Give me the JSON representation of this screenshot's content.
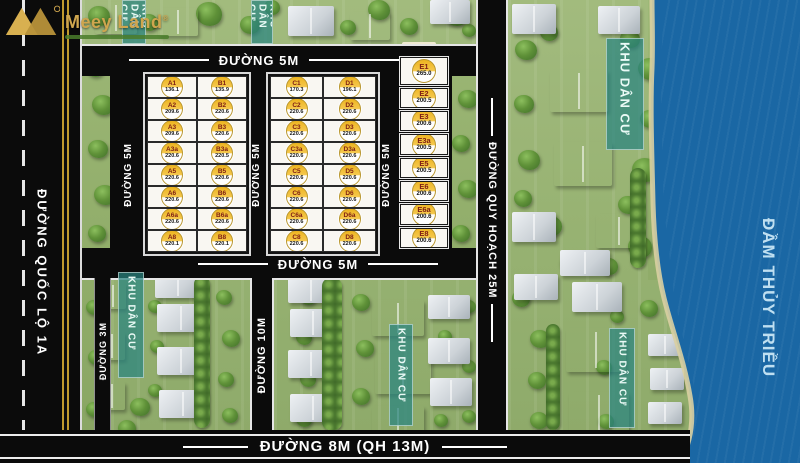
{
  "logo": {
    "brand": "Meey Land",
    "registered": "®"
  },
  "water": {
    "label": "ĐẦM THỦY TRIỀU"
  },
  "labels": {
    "residential": "KHU DÂN CƯ"
  },
  "roads": {
    "national_left": "ĐƯỜNG QUỐC LỘ 1A",
    "top": "ĐƯỜNG 5M",
    "inner_left": "ĐƯỜNG 5M",
    "inner_middle": "ĐƯỜNG 5M",
    "inner_right": "ĐƯỜNG 5M",
    "below_grid": "ĐƯỜNG 5M",
    "lower_left": "ĐƯỜNG 3M",
    "lower_middle": "ĐƯỜNG 10M",
    "planning_right": "ĐƯỜNG QUY HOẠCH 25M",
    "bottom": "ĐƯỜNG 8M (QH 13M)"
  },
  "colors": {
    "water": "#1a67a4",
    "road": "#0b0b0b",
    "badge_gold": "#edb41f",
    "residential_band": "#28847f",
    "logo_gold": "#cfa64e"
  },
  "plots": {
    "columns": [
      {
        "name": "A",
        "cells": [
          {
            "code": "A1",
            "area": "136.1"
          },
          {
            "code": "A2",
            "area": "209.6"
          },
          {
            "code": "A3",
            "area": "209.6"
          },
          {
            "code": "A3a",
            "area": "220.6"
          },
          {
            "code": "A5",
            "area": "220.6"
          },
          {
            "code": "A6",
            "area": "220.6"
          },
          {
            "code": "A6a",
            "area": "220.6"
          },
          {
            "code": "A8",
            "area": "220.1"
          }
        ]
      },
      {
        "name": "B",
        "cells": [
          {
            "code": "B1",
            "area": "135.9"
          },
          {
            "code": "B2",
            "area": "220.6"
          },
          {
            "code": "B3",
            "area": "220.6"
          },
          {
            "code": "B3a",
            "area": "220.5"
          },
          {
            "code": "B5",
            "area": "220.6"
          },
          {
            "code": "B6",
            "area": "220.6"
          },
          {
            "code": "B6a",
            "area": "220.6"
          },
          {
            "code": "B8",
            "area": "220.1"
          }
        ]
      },
      {
        "name": "C",
        "cells": [
          {
            "code": "C1",
            "area": "170.3"
          },
          {
            "code": "C2",
            "area": "220.6"
          },
          {
            "code": "C3",
            "area": "220.6"
          },
          {
            "code": "C3a",
            "area": "220.6"
          },
          {
            "code": "C5",
            "area": "220.6"
          },
          {
            "code": "C6",
            "area": "220.6"
          },
          {
            "code": "C6a",
            "area": "220.6"
          },
          {
            "code": "C8",
            "area": "220.6"
          }
        ]
      },
      {
        "name": "D",
        "cells": [
          {
            "code": "D1",
            "area": "196.1"
          },
          {
            "code": "D2",
            "area": "220.6"
          },
          {
            "code": "D3",
            "area": "220.6"
          },
          {
            "code": "D3a",
            "area": "220.6"
          },
          {
            "code": "D5",
            "area": "220.6"
          },
          {
            "code": "D6",
            "area": "220.6"
          },
          {
            "code": "D6a",
            "area": "220.6"
          },
          {
            "code": "D8",
            "area": "220.6"
          }
        ]
      },
      {
        "name": "E",
        "cells": [
          {
            "code": "E1",
            "area": "265.0"
          },
          {
            "code": "E2",
            "area": "200.5"
          },
          {
            "code": "E3",
            "area": "200.6"
          },
          {
            "code": "E3a",
            "area": "200.5"
          },
          {
            "code": "E5",
            "area": "200.5"
          },
          {
            "code": "E6",
            "area": "200.6"
          },
          {
            "code": "E6a",
            "area": "200.6"
          },
          {
            "code": "E8",
            "area": "200.6"
          }
        ]
      }
    ]
  }
}
